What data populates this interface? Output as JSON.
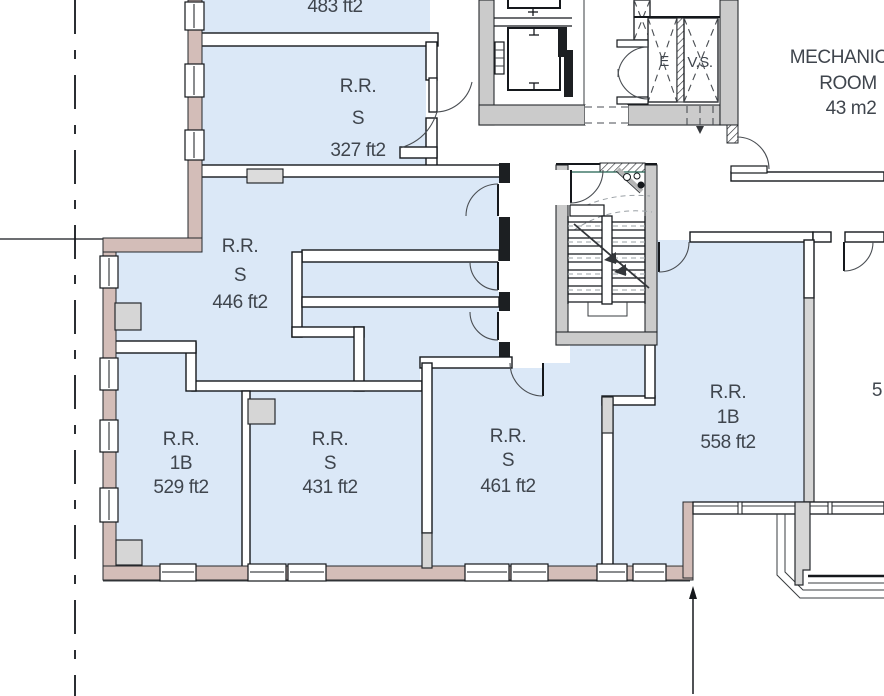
{
  "colors": {
    "room_fill": "#dbe8f7",
    "core_gray": "#cbcbcb",
    "exterior_wall": "#d3bdb8",
    "column_gray": "#d6d6d6",
    "text_color": "#3f454d"
  },
  "rooms": {
    "r483": {
      "area": "483 ft2"
    },
    "r327": {
      "label": "R.R.",
      "type": "S",
      "area": "327 ft2"
    },
    "r446": {
      "label": "R.R.",
      "type": "S",
      "area": "446 ft2"
    },
    "r529": {
      "label": "R.R.",
      "type": "1B",
      "area": "529 ft2"
    },
    "r431": {
      "label": "R.R.",
      "type": "S",
      "area": "431 ft2"
    },
    "r461": {
      "label": "R.R.",
      "type": "S",
      "area": "461 ft2"
    },
    "r558": {
      "label": "R.R.",
      "type": "1B",
      "area": "558 ft2"
    }
  },
  "mechanical_room": {
    "line1": "MECHANICAL",
    "line2": "ROOM",
    "area": "43 m2"
  },
  "shafts": {
    "elevator": "E",
    "vent": "V.S."
  },
  "edge_labels": {
    "right_partial": "5"
  }
}
